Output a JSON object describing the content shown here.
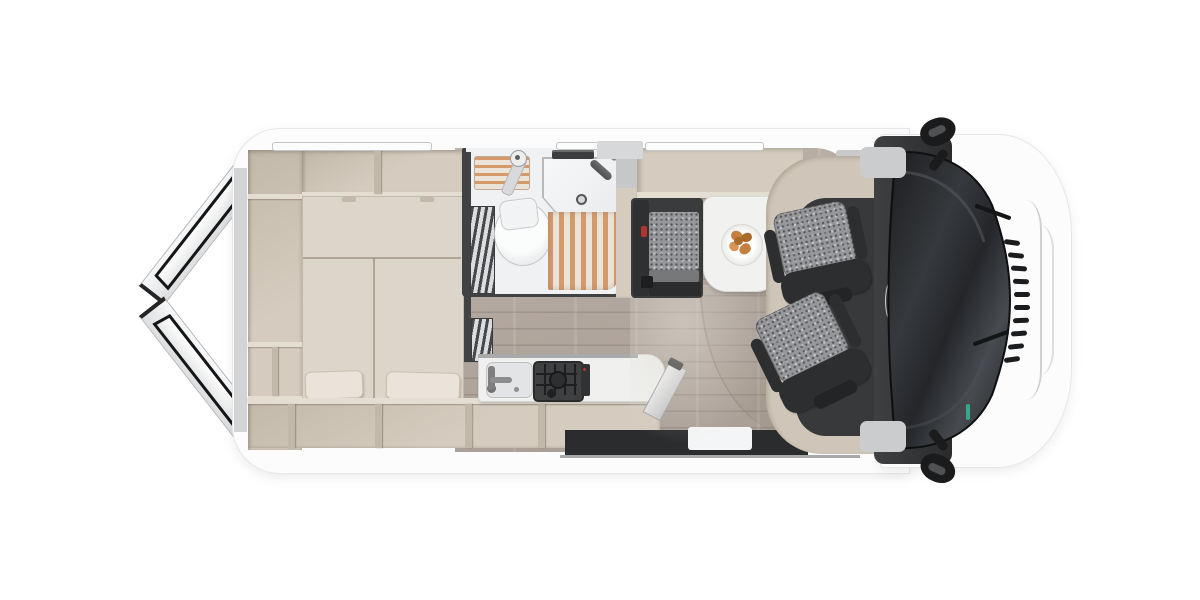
{
  "brand": {
    "logo_text": "carado"
  },
  "palette": {
    "bg": "#ffffff",
    "body": "#fcfcfd",
    "bodyline": "#e6e7e9",
    "grayacc": "#cbccce",
    "beige": "#d5ccbf",
    "beigedark": "#c2b8aa",
    "beigerail": "#e4ddd2",
    "mattress": "#dcd5c9",
    "pillow": "#e9e3d9",
    "wood": "#b2a79e",
    "bathwhite": "#eff1f2",
    "bathframe": "#404244",
    "slat": "#d49a6c",
    "slatbg": "#eae3d8",
    "stripedark": "#46484b",
    "stripelight": "#dcddde",
    "bench": "#3a3b3d",
    "benchbase": "#2b2c2e",
    "seatfab": "#96979a",
    "seatdark": "#2d2e30",
    "cabframe": "#cfc6b9",
    "cabfloor": "#38393b",
    "table": "#f1f1ef",
    "plate": "#fbfbfa",
    "crois1": "#c5803f",
    "crois2": "#a96a2c",
    "crois3": "#d89455",
    "glassdark": "#1d1e20",
    "glassmid": "#3a3d41",
    "mirror": "#1a1b1c",
    "steel1": "#e8e9eb",
    "steel2": "#9fa1a3",
    "entry": "#2b2c2e",
    "green": "#36a68c",
    "red": "#b23430",
    "logocol": "#e2e3e5",
    "vent": "#3c3d3f"
  },
  "objects": [
    "rear-doors-open",
    "rear-storage-shelves",
    "wardrobe-column",
    "double-bed",
    "pillows",
    "bathroom",
    "toilet",
    "corner-washbasin",
    "shower-slatted-floor",
    "folding-shower-screen",
    "kitchen-counter",
    "kitchen-sink",
    "gas-stove",
    "counter-extension-flap",
    "dinette-bench",
    "dining-table",
    "breakfast-plate-croissants",
    "swivel-cab-seat-passenger",
    "swivel-cab-seat-driver",
    "dashboard",
    "windshield",
    "side-mirrors",
    "entry-step",
    "sliding-door-opening",
    "roof-windows",
    "roof-vent"
  ]
}
